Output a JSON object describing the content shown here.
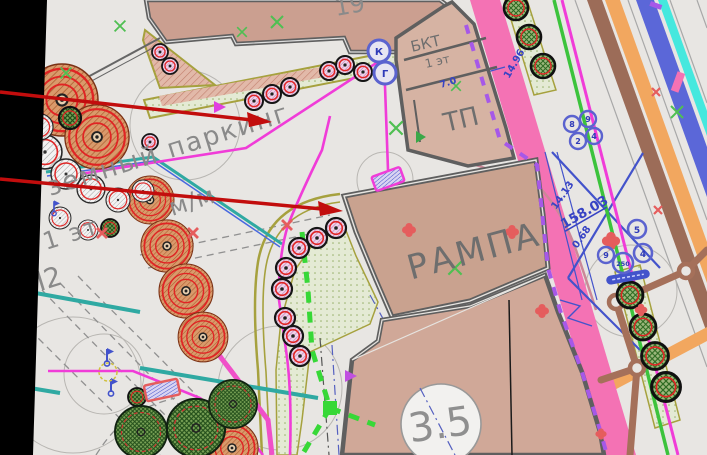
{
  "labels": {
    "building_19": "19",
    "bkt": "БКТ",
    "bkt_floors": "1 эт",
    "tp": "ТП",
    "ramp": "РАМПА",
    "axis_bubble": "3.5",
    "parking_line1": "земный паркинг",
    "parking_line2a": "1 эт",
    "parking_line2b": "м/м",
    "parking_line3": "П2"
  },
  "dimensions": {
    "d_7_0": "7.0",
    "d_14_96": "14.96",
    "d_14_13": "14.13",
    "d_158_03": "158.03",
    "d_0_68": "0.68"
  },
  "wells": {
    "w_k": "К",
    "w_g": "Г",
    "c1": "8",
    "c2": "9",
    "c3": "2",
    "c4": "4",
    "m1": "5",
    "m2": "4",
    "m3": "250",
    "m4": "9"
  },
  "colors": {
    "background": "#e8e6e3",
    "building_fill": "#cda193",
    "pink_band": "#f472b4",
    "magenta_line": "#f03cd8",
    "green_line": "#3cc33c",
    "teal_line": "#2fa9a2",
    "blue_band": "#5b67d8",
    "cyan_line": "#45e8de",
    "brown_band": "#9c6c58",
    "orange_band": "#f2a75f",
    "olive_line": "#a6a13e",
    "dim_blue": "#3743c4",
    "violet_dash": "#a658e8",
    "arrow_red": "#c20d0d",
    "marker_salmon": "#e55d5d",
    "tick_green": "#4fbf52"
  }
}
